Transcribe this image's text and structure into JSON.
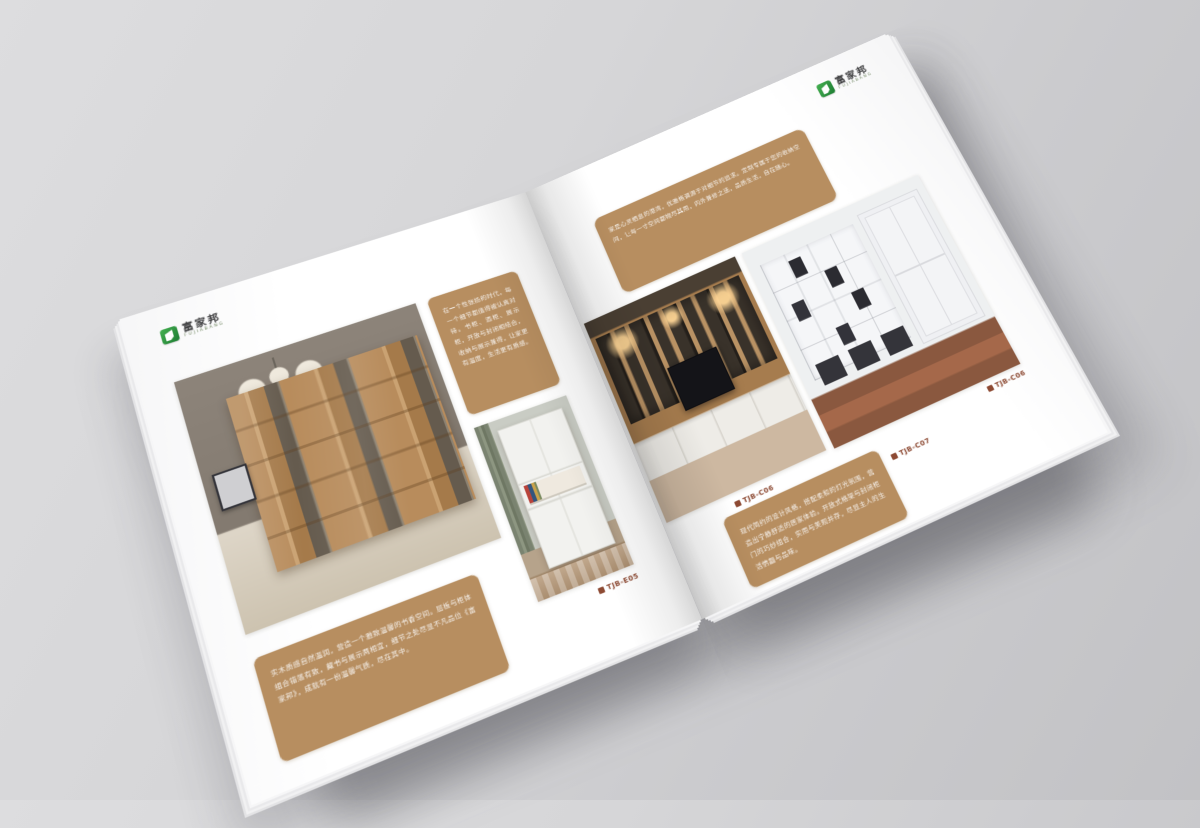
{
  "brand": {
    "name_cn": "富家邦",
    "name_en": "FUJIABANG",
    "accent_green": "#2f9f44"
  },
  "palette": {
    "backdrop_gray": "#d2d2d5",
    "page_white": "#ffffff",
    "tan_block": "#b78e60",
    "code_text": "#8d4a33"
  },
  "left_page": {
    "intro_text": "在一个性张扬的时代，每一个细节都值得被认真对待。书柜、酒柜、展示柜，开放与封闭相结合，收纳与展示兼得，让家更有温度，生活更有质感。",
    "bottom_text": "实木质感自然温润，营造一个雅致温馨的书香空间。层板与柜体组合错落有致，藏书与展示两相宜，细节之处尽显不凡品位《富家邦》，成就有一份温馨气质，尽在其中。",
    "product_code": "TJB-E05"
  },
  "right_page": {
    "top_text": "家是心灵栖息的港湾，优雅格调源于对细节的追求。定制专属于您的收纳空间，让每一寸空间都物尽其用，内外兼修之选，品质生活，自在随心。",
    "bottom_text": "现代简约的设计风格，搭配柔和的灯光氛围，营造出宁静舒适的居家体验。开放式格架与封闭柜门的巧妙组合，实用与美观并存，尽显主人的生活情趣与品味。",
    "code_tv_wall": "TJB-C06",
    "code_cabinet": "TJB-C06",
    "code_bottom": "TJB-C07"
  }
}
